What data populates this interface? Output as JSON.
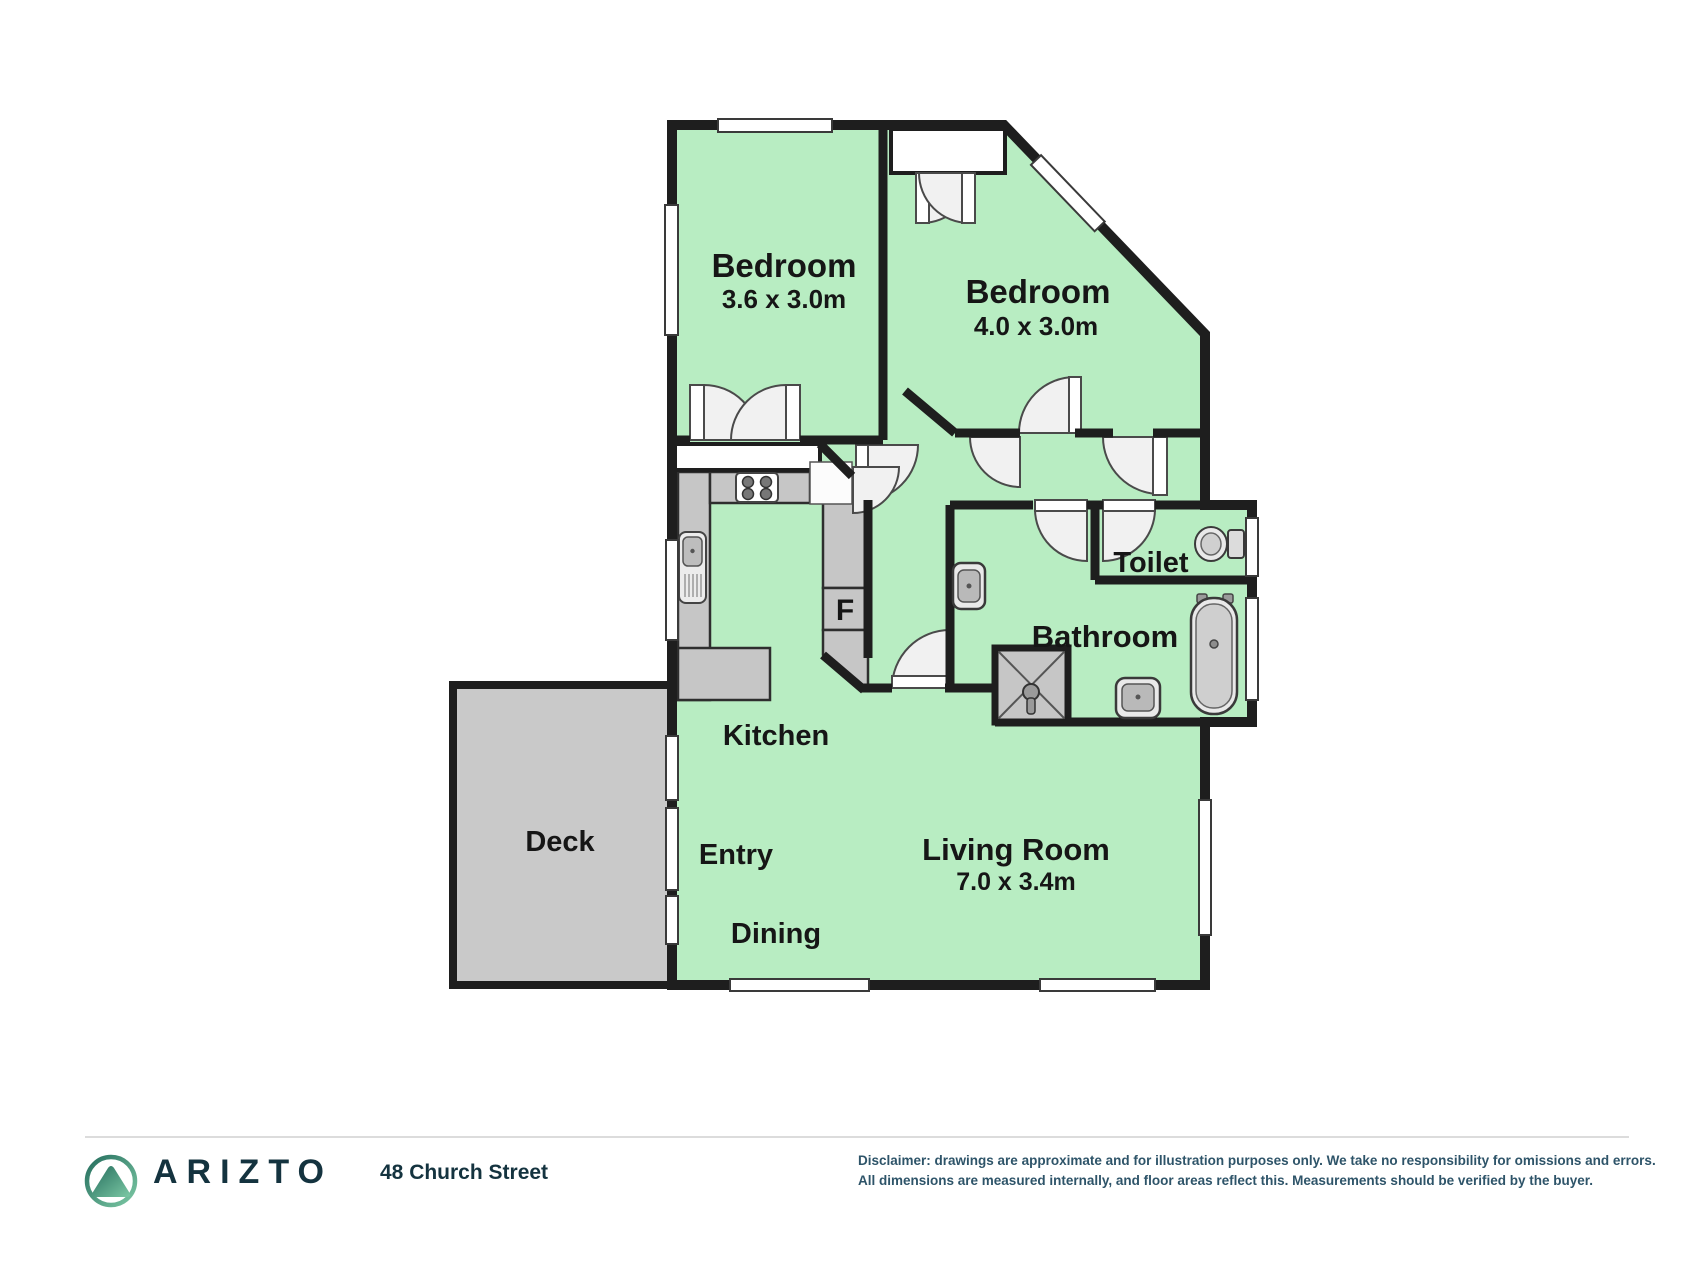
{
  "floorplan": {
    "rooms": [
      {
        "label": "Bedroom",
        "dims": "3.6 x 3.0m"
      },
      {
        "label": "Bedroom",
        "dims": "4.0 x 3.0m"
      },
      {
        "label": "Toilet",
        "dims": ""
      },
      {
        "label": "Bathroom",
        "dims": ""
      },
      {
        "label": "Kitchen",
        "dims": ""
      },
      {
        "label": "Deck",
        "dims": ""
      },
      {
        "label": "Entry",
        "dims": ""
      },
      {
        "label": "Dining",
        "dims": ""
      },
      {
        "label": "Living Room",
        "dims": "7.0 x 3.4m"
      }
    ],
    "fridge_label": "F",
    "colors": {
      "room_fill": "#b8edc2",
      "wall": "#1e1e1e",
      "deck_fill": "#c9c9c9",
      "counter_fill": "#c6c6c6",
      "door_fill": "#f1f1f1",
      "brand_navy": "#14333f",
      "disclaimer_color": "#2e5469",
      "logo_teal_dark": "#256e5e",
      "logo_teal_light": "#7cc8a4"
    }
  },
  "footer": {
    "brand": "ARIZTO",
    "address": "48 Church Street",
    "disclaimer_line1": "Disclaimer: drawings are approximate and for illustration purposes only. We take no responsibility for omissions and errors.",
    "disclaimer_line2": "All dimensions are measured internally, and floor areas reflect this. Measurements should be verified by the buyer."
  }
}
